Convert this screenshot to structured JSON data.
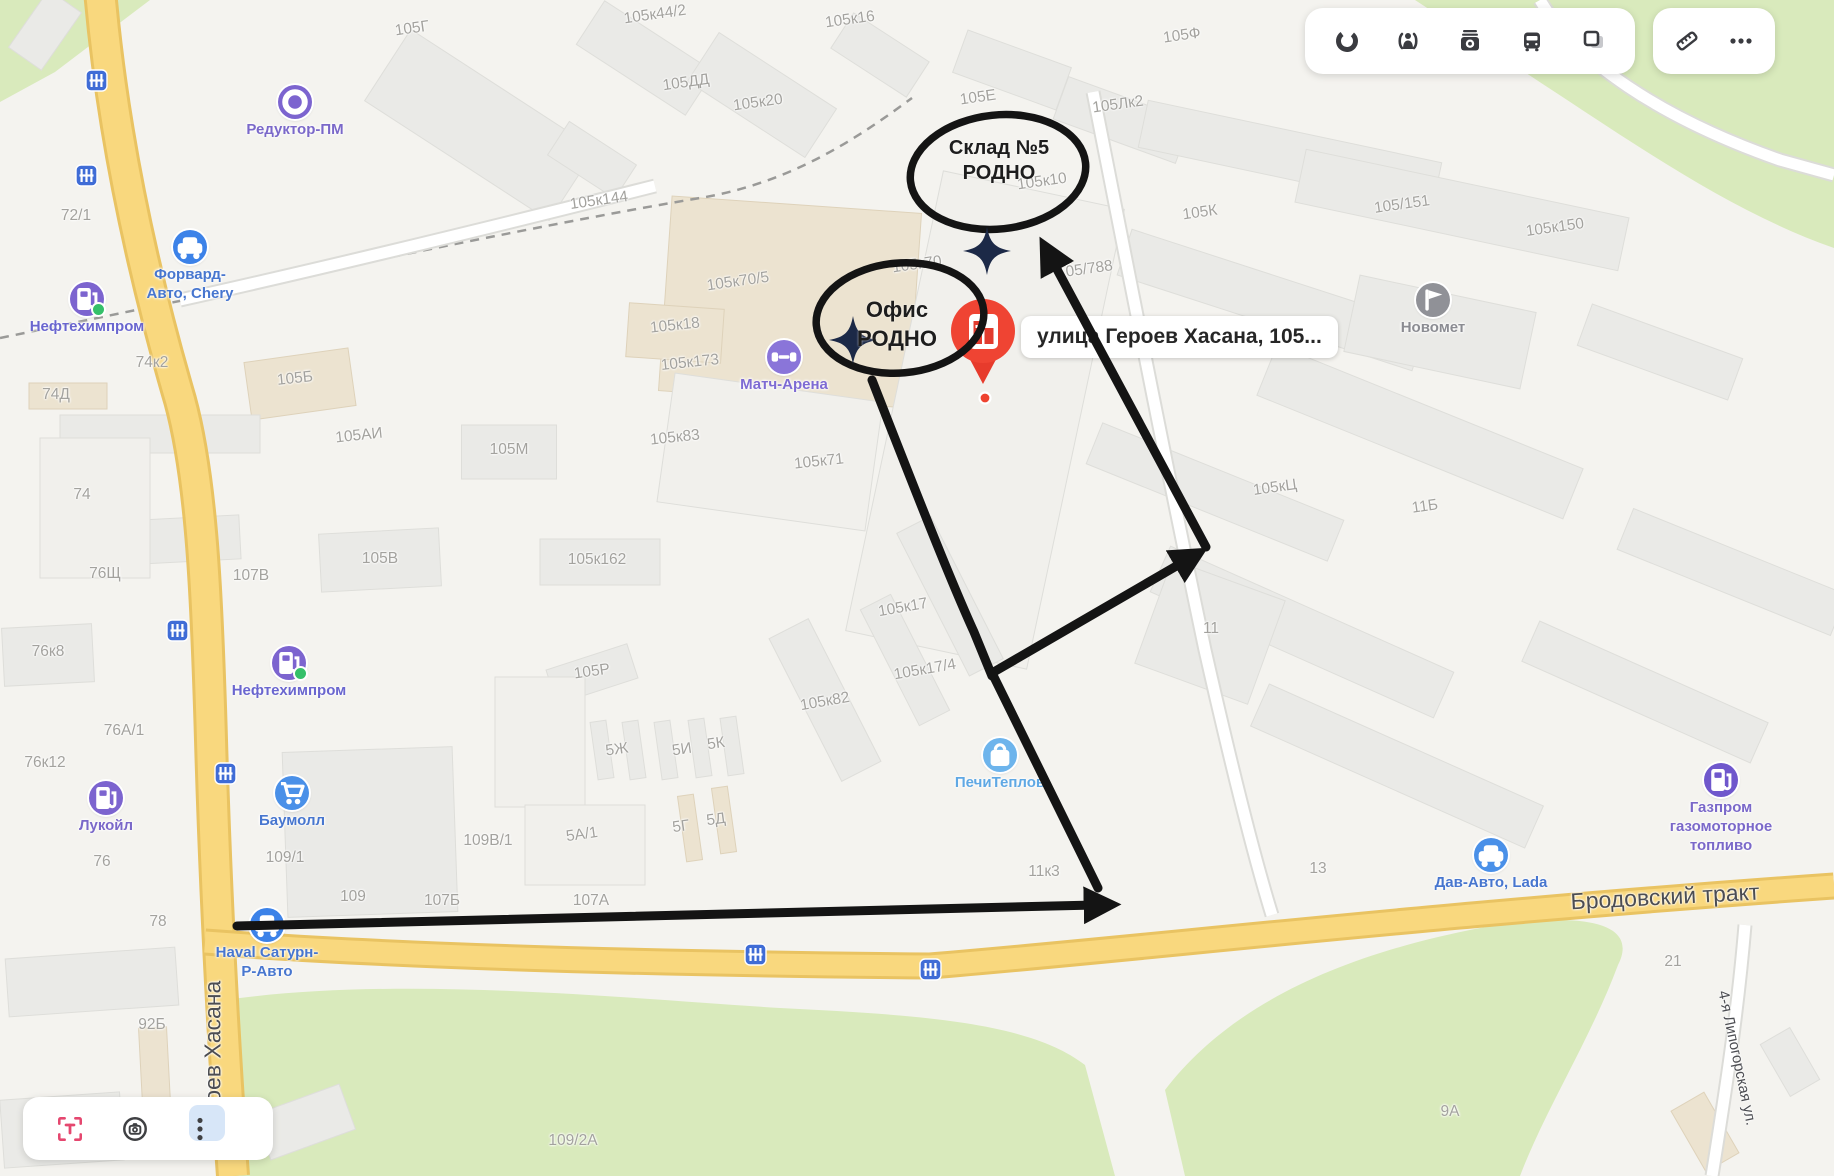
{
  "toolbar": {
    "main_icons": [
      "traffic-icon",
      "panoramas-icon",
      "photos-icon",
      "transport-icon",
      "layers-icon"
    ],
    "extra_icons": [
      "ruler-icon",
      "more-icon"
    ]
  },
  "bottom_controls": [
    "text-recognition-icon",
    "image-search-icon",
    "more-vertical-icon"
  ],
  "pin": {
    "address": "улица Героев Хасана, 105..."
  },
  "annotations": {
    "warehouse": {
      "line1": "Склад №5",
      "line2": "РОДНО"
    },
    "office": {
      "line1": "Офис",
      "line2": "РОДНО"
    }
  },
  "colors": {
    "annotation_black": "#141414",
    "pin_red": "#ee4330",
    "road_yellow": "#f9d87e",
    "green_area": "#d9eabc",
    "poi_blue": "#3c82e8",
    "poi_purple": "#7c64cf",
    "shield_blue": "#3f6cd6"
  },
  "map": {
    "street_labels": [
      {
        "t": "Бродовский тракт",
        "x": 1665,
        "y": 897,
        "r": -3,
        "s": 23
      },
      {
        "t": "Героев Хасана",
        "x": 213,
        "y": 1060,
        "r": -90,
        "s": 23
      },
      {
        "t": "4-я Липогорская ул.",
        "x": 1737,
        "y": 1058,
        "r": 78,
        "s": 15
      }
    ],
    "building_labels": [
      {
        "t": "105Г",
        "x": 412,
        "y": 29,
        "r": -8
      },
      {
        "t": "105к44/2",
        "x": 655,
        "y": 15,
        "r": -8
      },
      {
        "t": "105к16",
        "x": 850,
        "y": 20,
        "r": -8
      },
      {
        "t": "105Ф",
        "x": 1182,
        "y": 36,
        "r": -8
      },
      {
        "t": "105ДД",
        "x": 686,
        "y": 83,
        "r": -8
      },
      {
        "t": "105к20",
        "x": 758,
        "y": 103,
        "r": -8
      },
      {
        "t": "105Е",
        "x": 978,
        "y": 98,
        "r": -8
      },
      {
        "t": "105Лк2",
        "x": 1118,
        "y": 105,
        "r": -8
      },
      {
        "t": "105к10",
        "x": 1042,
        "y": 182,
        "r": -8
      },
      {
        "t": "105К",
        "x": 1200,
        "y": 213,
        "r": -8
      },
      {
        "t": "105/151",
        "x": 1402,
        "y": 205,
        "r": -8
      },
      {
        "t": "105к150",
        "x": 1555,
        "y": 228,
        "r": -8
      },
      {
        "t": "72/1",
        "x": 76,
        "y": 216
      },
      {
        "t": "105к144",
        "x": 599,
        "y": 201,
        "r": -8
      },
      {
        "t": "105к70/5",
        "x": 738,
        "y": 282,
        "r": -8
      },
      {
        "t": "105к70",
        "x": 917,
        "y": 265,
        "r": -8
      },
      {
        "t": "105/788",
        "x": 1085,
        "y": 270,
        "r": -8
      },
      {
        "t": "105к18",
        "x": 675,
        "y": 326,
        "r": -6
      },
      {
        "t": "105к173",
        "x": 690,
        "y": 363,
        "r": -6
      },
      {
        "t": "74к2",
        "x": 152,
        "y": 363
      },
      {
        "t": "105Б",
        "x": 295,
        "y": 379,
        "r": -6
      },
      {
        "t": "74Д",
        "x": 56,
        "y": 395
      },
      {
        "t": "105АИ",
        "x": 359,
        "y": 436,
        "r": -6
      },
      {
        "t": "105М",
        "x": 509,
        "y": 450
      },
      {
        "t": "105к83",
        "x": 675,
        "y": 438,
        "r": -6
      },
      {
        "t": "105к71",
        "x": 819,
        "y": 462,
        "r": -6
      },
      {
        "t": "74",
        "x": 82,
        "y": 495
      },
      {
        "t": "105В",
        "x": 380,
        "y": 559
      },
      {
        "t": "76Щ",
        "x": 105,
        "y": 574
      },
      {
        "t": "107В",
        "x": 251,
        "y": 576
      },
      {
        "t": "105к162",
        "x": 597,
        "y": 560
      },
      {
        "t": "105кЦ",
        "x": 1275,
        "y": 488,
        "r": -8
      },
      {
        "t": "11Б",
        "x": 1425,
        "y": 507,
        "r": -8
      },
      {
        "t": "76к8",
        "x": 48,
        "y": 652
      },
      {
        "t": "105Р",
        "x": 592,
        "y": 672,
        "r": -8
      },
      {
        "t": "105к17",
        "x": 903,
        "y": 608,
        "r": -10
      },
      {
        "t": "11",
        "x": 1211,
        "y": 629
      },
      {
        "t": "105к17/4",
        "x": 925,
        "y": 670,
        "r": -10
      },
      {
        "t": "105к82",
        "x": 825,
        "y": 702,
        "r": -10
      },
      {
        "t": "76А/1",
        "x": 124,
        "y": 731
      },
      {
        "t": "76к12",
        "x": 45,
        "y": 763
      },
      {
        "t": "5Ж",
        "x": 617,
        "y": 750,
        "r": -8
      },
      {
        "t": "5И",
        "x": 682,
        "y": 750,
        "r": -8
      },
      {
        "t": "5К",
        "x": 716,
        "y": 744,
        "r": -8
      },
      {
        "t": "76",
        "x": 102,
        "y": 862
      },
      {
        "t": "109В/1",
        "x": 488,
        "y": 841
      },
      {
        "t": "5А/1",
        "x": 582,
        "y": 835,
        "r": -8
      },
      {
        "t": "5Г",
        "x": 681,
        "y": 827,
        "r": -8
      },
      {
        "t": "5Д",
        "x": 716,
        "y": 820,
        "r": -8
      },
      {
        "t": "109/1",
        "x": 285,
        "y": 858
      },
      {
        "t": "109",
        "x": 353,
        "y": 897
      },
      {
        "t": "107Б",
        "x": 442,
        "y": 901
      },
      {
        "t": "107А",
        "x": 591,
        "y": 901
      },
      {
        "t": "11к3",
        "x": 1044,
        "y": 872
      },
      {
        "t": "78",
        "x": 158,
        "y": 922
      },
      {
        "t": "13",
        "x": 1318,
        "y": 869
      },
      {
        "t": "92Б",
        "x": 152,
        "y": 1025
      },
      {
        "t": "109/2А",
        "x": 573,
        "y": 1141
      },
      {
        "t": "9А",
        "x": 1450,
        "y": 1112
      },
      {
        "t": "21",
        "x": 1673,
        "y": 962
      }
    ],
    "pois": [
      {
        "label": [
          "Редуктор-ПМ"
        ],
        "x": 295,
        "y": 102,
        "icon": "ring",
        "color": "#7c64cf",
        "lc": "#7a68c9"
      },
      {
        "label": [
          "Форвард-",
          "Авто, Chery"
        ],
        "x": 190,
        "y": 247,
        "icon": "car",
        "color": "#3c82e8",
        "lc": "#4776cf"
      },
      {
        "label": [
          "Нефтехимпром"
        ],
        "x": 87,
        "y": 299,
        "icon": "fuel",
        "color": "#7c64cf",
        "lc": "#6a66cf",
        "dot": true
      },
      {
        "label": [
          "Матч-Арена"
        ],
        "x": 784,
        "y": 357,
        "icon": "dumbbell",
        "color": "#8a75d9",
        "lc": "#7e6bd3"
      },
      {
        "label": [
          "Новомет"
        ],
        "x": 1433,
        "y": 300,
        "icon": "flag",
        "color": "#909197",
        "lc": "#8b8c92"
      },
      {
        "label": [
          "Нефтехимпром"
        ],
        "x": 289,
        "y": 663,
        "icon": "fuel",
        "color": "#7c64cf",
        "lc": "#6a66cf",
        "dot": true
      },
      {
        "label": [
          "Лукойл"
        ],
        "x": 106,
        "y": 798,
        "icon": "fuel",
        "color": "#7c64cf",
        "lc": "#7a68c9"
      },
      {
        "label": [
          "Баумолл"
        ],
        "x": 292,
        "y": 793,
        "icon": "cart",
        "color": "#4a90e8",
        "lc": "#4776cf"
      },
      {
        "label": [
          "ПечиТеплов"
        ],
        "x": 1000,
        "y": 755,
        "icon": "bag",
        "color": "#6db4ec",
        "lc": "#5fa8e4"
      },
      {
        "label": [
          "Haval Сатурн-",
          "Р-Авто"
        ],
        "x": 267,
        "y": 925,
        "icon": "car",
        "color": "#3c82e8",
        "lc": "#4776cf"
      },
      {
        "label": [
          "Дав-Авто, Lada"
        ],
        "x": 1491,
        "y": 855,
        "icon": "car",
        "color": "#4a90e8",
        "lc": "#4776cf"
      },
      {
        "label": [
          "Газпром",
          "газомоторное",
          "топливо"
        ],
        "x": 1721,
        "y": 780,
        "icon": "fuel",
        "color": "#6f57cc",
        "lc": "#7a68c9"
      }
    ],
    "rail_shields": [
      {
        "x": 96,
        "y": 80
      },
      {
        "x": 86,
        "y": 175
      },
      {
        "x": 177,
        "y": 630
      },
      {
        "x": 225,
        "y": 773
      },
      {
        "x": 755,
        "y": 954
      },
      {
        "x": 930,
        "y": 969
      }
    ]
  }
}
